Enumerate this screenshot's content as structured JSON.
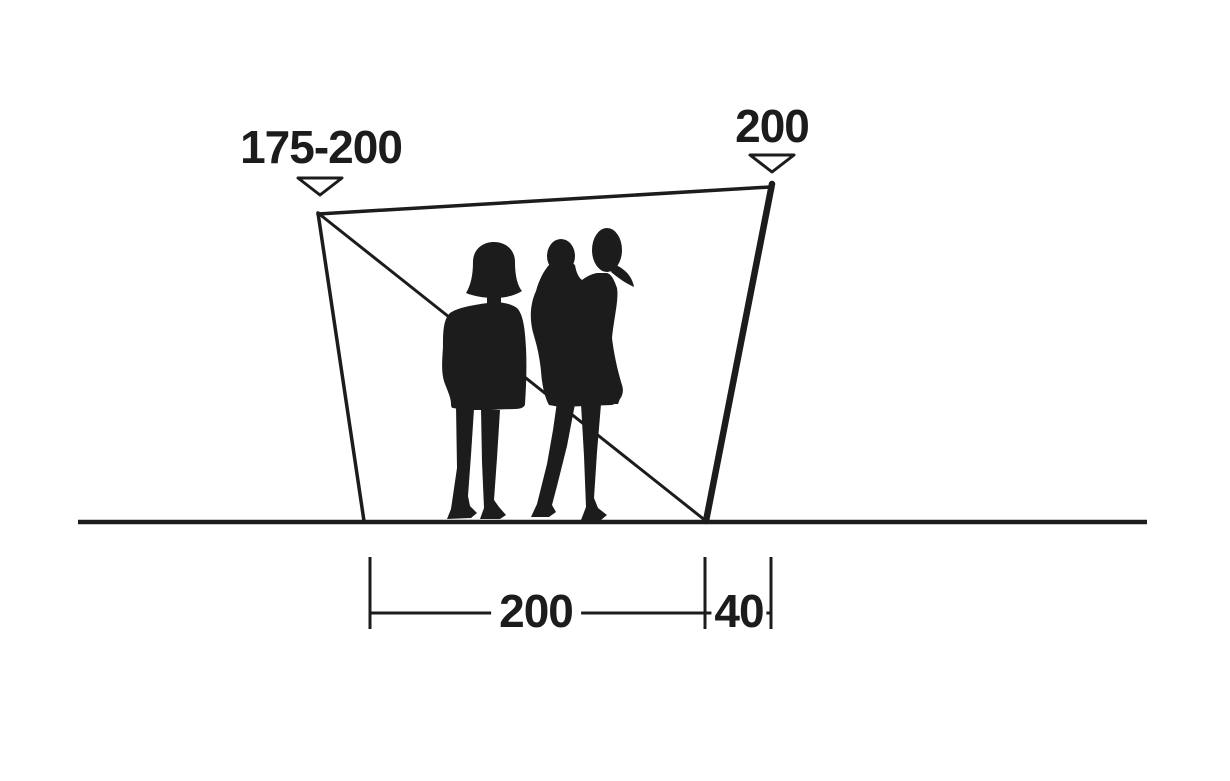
{
  "labels": {
    "pole_height_left": "175-200",
    "pole_height_right": "200",
    "base_width": "200",
    "side_offset": "40"
  },
  "colors": {
    "ink": "#1c1c1c",
    "background": "#ffffff"
  },
  "figure": {
    "description_left": "woman-standing-silhouette",
    "description_right": "adult-holding-child-silhouette"
  }
}
